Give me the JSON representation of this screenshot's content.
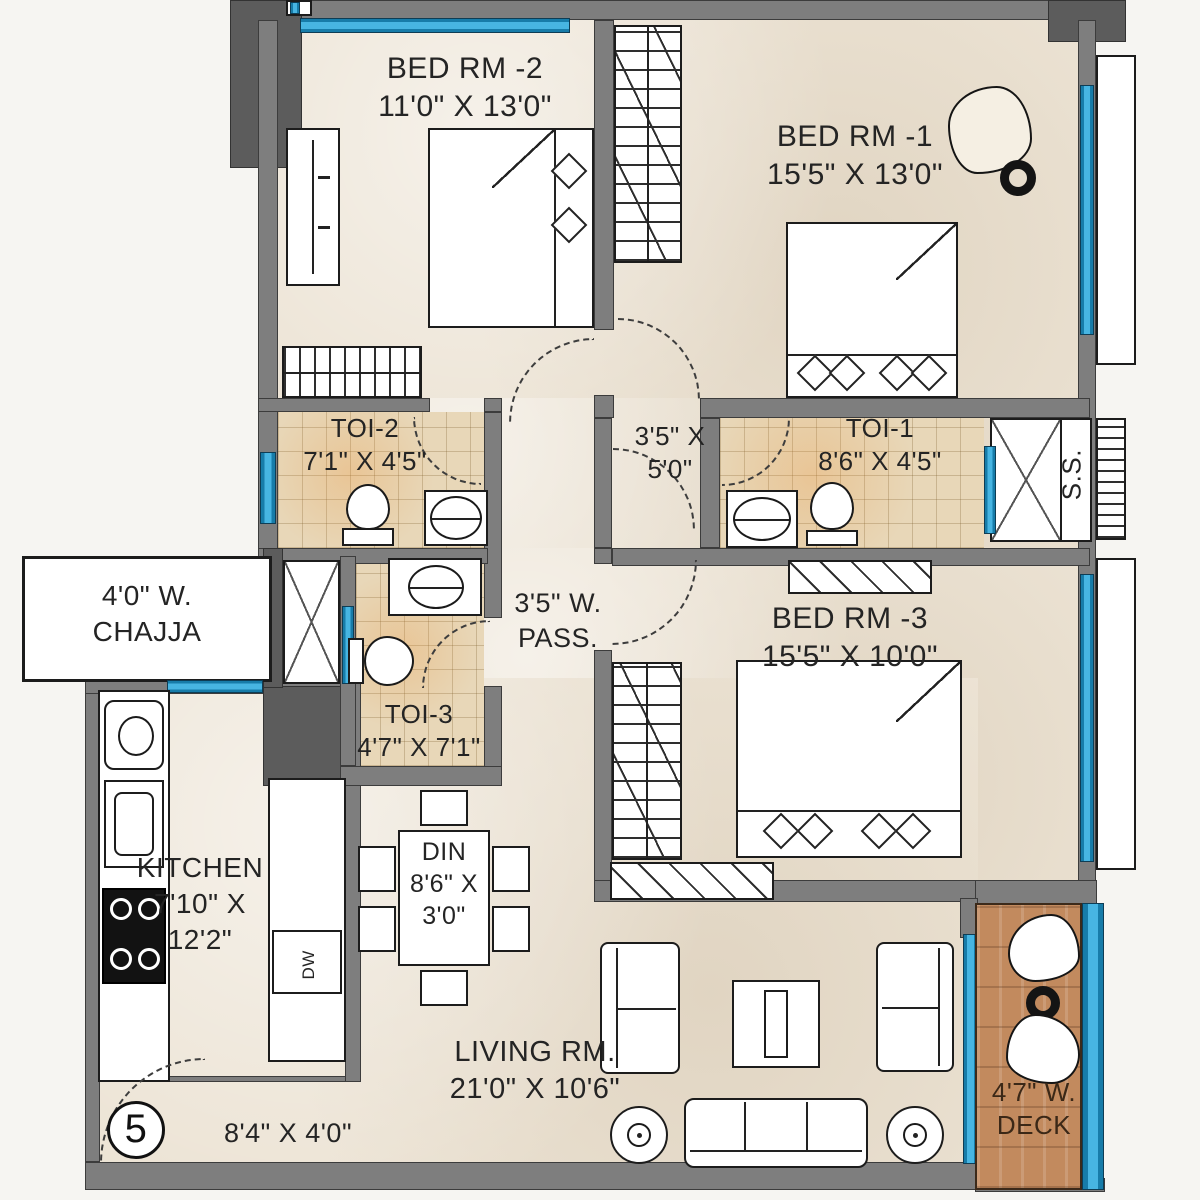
{
  "plan_title": "Unit 5 floor plan",
  "colors": {
    "wall": "#7e7e7e",
    "wall_dark": "#5c5c5c",
    "floor_marble": "#ece3d4",
    "toilet_tile": "#e8d7b8",
    "window_blue": "#47b5e2",
    "deck_wood": "#c28a5e"
  },
  "rooms": {
    "bed2": {
      "label": "BED RM -2",
      "size": "11'0\" X 13'0\""
    },
    "bed1": {
      "label": "BED RM -1",
      "size": "15'5\" X 13'0\""
    },
    "bed3": {
      "label": "BED RM -3",
      "size": "15'5\" X 10'0\""
    },
    "toi2": {
      "label": "TOI-2",
      "size": "7'1\" X 4'5\""
    },
    "toi1": {
      "label": "TOI-1",
      "size": "8'6\" X 4'5\""
    },
    "toi3": {
      "label": "TOI-3",
      "size": "4'7\" X 7'1\""
    },
    "lobby": {
      "size_line1": "3'5\" X",
      "size_line2": "5'0\""
    },
    "shaft": {
      "label": "S.S."
    },
    "chajja": {
      "size_line1": "4'0\" W.",
      "size_line2": "CHAJJA"
    },
    "passage": {
      "size_line1": "3'5\" W.",
      "size_line2": "PASS."
    },
    "kitchen": {
      "label": "KITCHEN",
      "size_line1": "7'10\" X",
      "size_line2": "12'2\""
    },
    "dining": {
      "label": "DIN",
      "size_line1": "8'6\" X",
      "size_line2": "3'0\""
    },
    "living": {
      "label": "LIVING RM.",
      "size": "21'0\" X 10'6\""
    },
    "foyer": {
      "unit_number": "5",
      "size": "8'4\" X 4'0\""
    },
    "deck": {
      "size_line1": "4'7\" W.",
      "size_line2": "DECK"
    }
  },
  "appliances": {
    "dishwasher": "DW"
  }
}
